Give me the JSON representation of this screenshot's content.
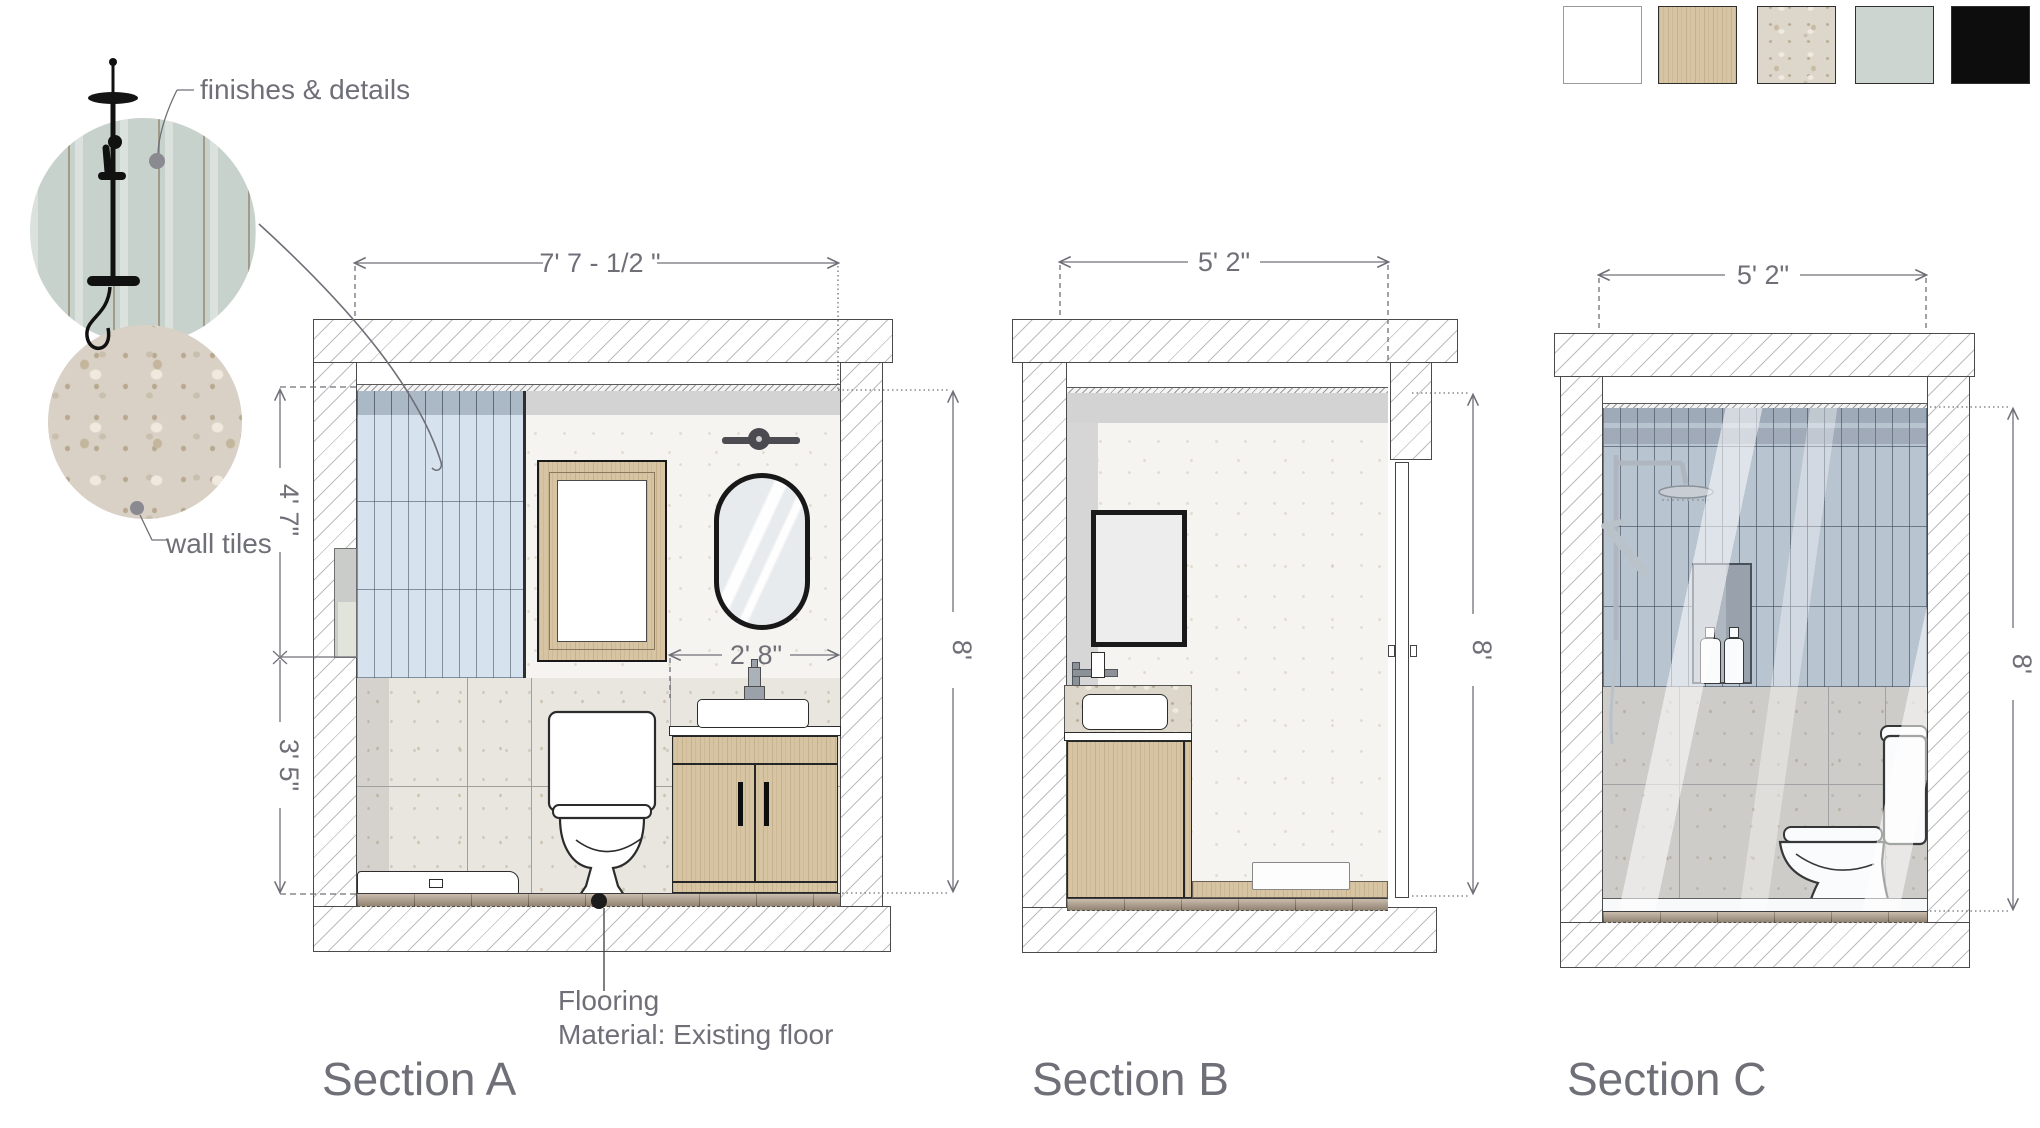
{
  "palette": {
    "line_gray": "#6f6f78",
    "wall_outline": "#4a4a4a",
    "shower_tile_blue": "#d6e2ee",
    "shower_tile_blue_dark": "#abb8c5",
    "wood": "#d7c4a2",
    "terrazzo": "#ddd6cb",
    "sage_tile": "#c8d2cc",
    "floor_tile": "#b2a08b",
    "soffit_gray": "#d3d3d3"
  },
  "swatches": [
    {
      "name": "white-paint",
      "color": "#ffffff"
    },
    {
      "name": "light-wood-veneer",
      "color": "#d7c4a2"
    },
    {
      "name": "terrazzo-stone",
      "color": "#ddd6cb"
    },
    {
      "name": "sage-green-tile",
      "color": "#ccd5cf"
    },
    {
      "name": "matte-black",
      "color": "#0d0d0d"
    }
  ],
  "annotations": {
    "finishes_label": "finishes & details",
    "wall_tiles_label": "wall tiles",
    "flooring_line1": "Flooring",
    "flooring_line2": "Material:  Existing floor"
  },
  "sections": {
    "a": {
      "label": "Section A",
      "dim_width": "7' 7 -  1/2 \"",
      "dim_height": "8'",
      "dim_wall_upper": "4' 7\"",
      "dim_wall_lower": "3' 5\"",
      "dim_vanity_width": "2' 8\""
    },
    "b": {
      "label": "Section B",
      "dim_width": "5' 2\"",
      "dim_height": "8'"
    },
    "c": {
      "label": "Section C",
      "dim_width": "5' 2\"",
      "dim_height": "8'"
    }
  }
}
